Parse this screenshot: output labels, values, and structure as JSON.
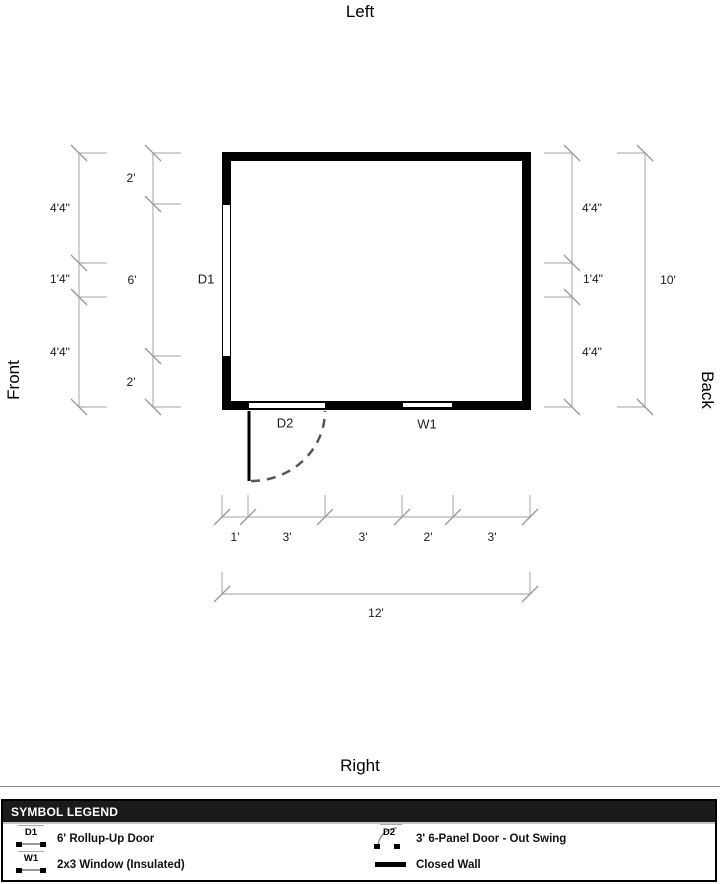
{
  "orientation": {
    "top": "Left",
    "bottom": "Right",
    "left": "Front",
    "right": "Back"
  },
  "plan": {
    "door_left": {
      "label": "D1"
    },
    "door_front": {
      "label": "D2"
    },
    "window_front": {
      "label": "W1"
    }
  },
  "dimensions": {
    "left_outer": [
      "4'4\"",
      "1'4\"",
      "4'4\""
    ],
    "left_inner": [
      "2'",
      "6'",
      "2'"
    ],
    "right_inner": [
      "4'4\"",
      "1'4\"",
      "4'4\""
    ],
    "right_total": "10'",
    "bottom_segments": [
      "1'",
      "3'",
      "3'",
      "2'",
      "3'"
    ],
    "bottom_total": "12'"
  },
  "legend": {
    "title": "SYMBOL LEGEND",
    "items": [
      {
        "code": "D1",
        "icon": "flat-opening-symbol",
        "label": "6' Rollup-Up Door"
      },
      {
        "code": "D2",
        "icon": "swing-door-symbol",
        "label": "3' 6-Panel Door - Out Swing"
      },
      {
        "code": "W1",
        "icon": "window-symbol",
        "label": "2x3 Window (Insulated)"
      },
      {
        "code": "",
        "icon": "closed-wall-symbol",
        "label": "Closed Wall"
      }
    ]
  },
  "colors": {
    "wall": "#000000",
    "dimension_line": "#b5b5b5",
    "dimension_slash": "#999999",
    "swing_arc": "#555555",
    "legend_header_bg": "#1b1b1b",
    "legend_header_text": "#ffffff"
  }
}
